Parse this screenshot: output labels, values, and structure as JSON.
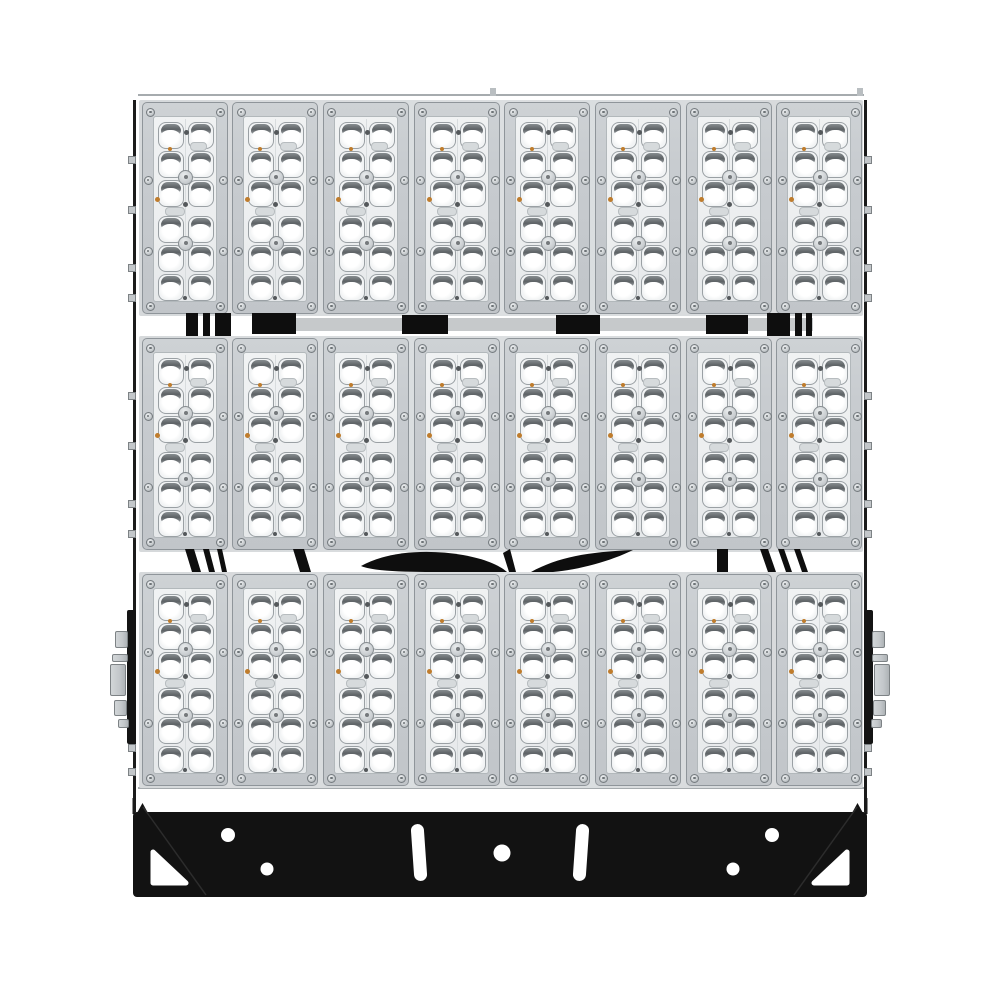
{
  "image": {
    "description": "Front view product photo of a modular LED high-mast stadium floodlight on a white background",
    "background_color": "#ffffff"
  },
  "fixture": {
    "rows": 3,
    "columns": 8,
    "modules_total": 24,
    "module": {
      "lens_columns": 2,
      "lens_rows": 6,
      "lenses_per_module": 12,
      "screws_per_module": 8,
      "center_bosses": 2
    },
    "lenses_total": 288,
    "side_rail_tabs_per_side": 10,
    "wiring_bands_between_rows": 2,
    "side_mount_arms": 2
  },
  "bracket": {
    "shape": "black trapezoid base plate with corner gussets",
    "round_holes": 5,
    "slot_holes": 2,
    "triangular_cutouts": 2
  },
  "colors": {
    "background": "#ffffff",
    "rail_black": "#1b1b1b",
    "cable_black": "#0e0e0e",
    "bracket_black": "#121212",
    "frame_grey": "#c8ccd0",
    "frame_border": "#8f959a",
    "panel_grey": "#eceeef",
    "panel_border": "#b2b8bb",
    "lens_base": "#f2f4f5",
    "lens_border": "#9aa0a4",
    "lens_brow": "#5d6265",
    "lens_shine": "#ffffff",
    "bar_grey": "#c6c9cb",
    "metal_grey": "#c3c7ca",
    "metal_border": "#7d8285",
    "screw_ring": "#757b7f",
    "detail_dark": "#54585b",
    "amber": "#bf7c2c",
    "row_bed": "#d6d9db"
  }
}
